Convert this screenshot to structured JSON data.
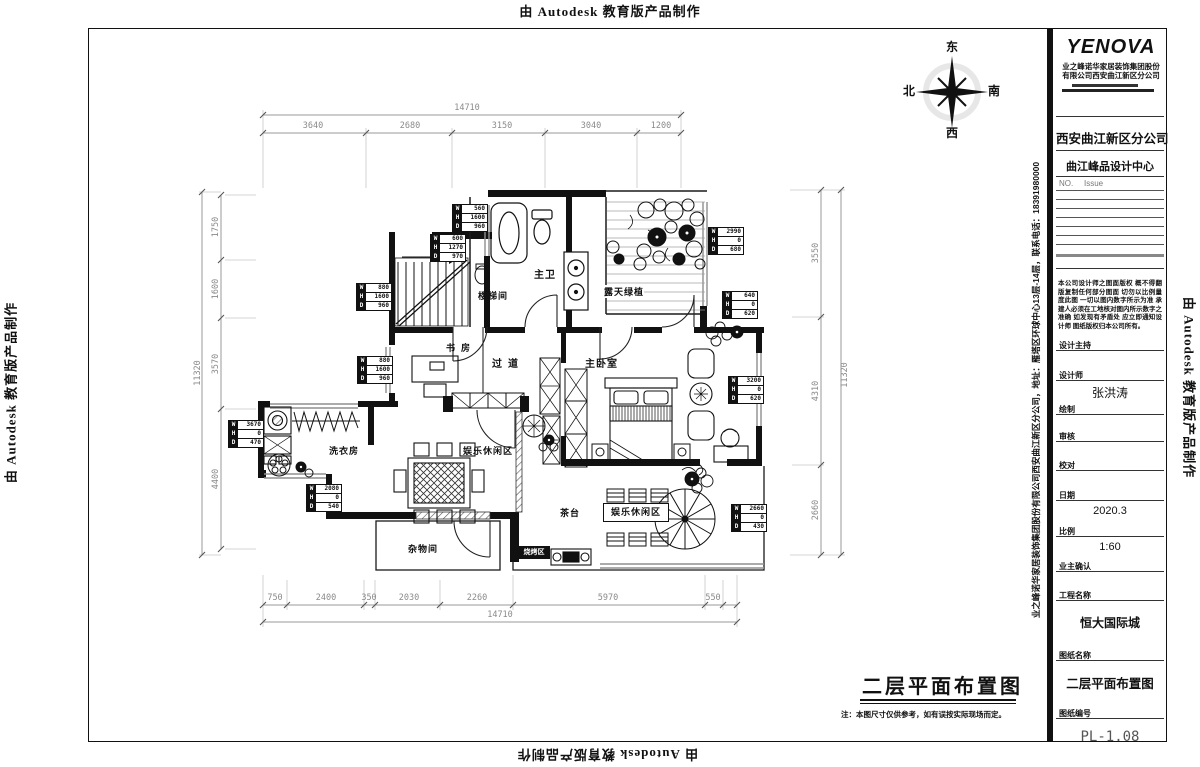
{
  "banner": {
    "text": "由 Autodesk 教育版产品制作"
  },
  "side_text": "业之峰诺华家居装饰集团股份有限公司西安曲江新区分公司，地址：雁塔区环球中心13层-14层，联系电话：18391980000",
  "compass": {
    "east": "东",
    "south": "南",
    "west": "西",
    "north": "北"
  },
  "plan": {
    "title": "二层平面布置图",
    "note": "注：本图尺寸仅供参考，如有误按实际现场而定。"
  },
  "rooms": [
    "主卫",
    "楼梯间",
    "露天绿植",
    "书房",
    "过道",
    "主卧室",
    "洗衣房",
    "娱乐休闲区",
    "杂物间",
    "茶台",
    "娱乐休闲区",
    "烧烤区"
  ],
  "dims": {
    "top_overall": "14710",
    "top_segments": [
      "3640",
      "2680",
      "3150",
      "3040",
      "1200"
    ],
    "bottom_overall": "14710",
    "bottom_segments": [
      "750",
      "2400",
      "350",
      "2030",
      "2260",
      "5970",
      "550"
    ],
    "left_overall": "11320",
    "left_segments": [
      "1750",
      "1600",
      "3570",
      "4400"
    ],
    "right_overall": "11320",
    "right_segments": [
      "3550",
      "4310",
      "2660"
    ]
  },
  "window_tag_keys": [
    "W",
    "H",
    "D"
  ],
  "window_tags": [
    {
      "w": "560",
      "h": "1600",
      "d": "960"
    },
    {
      "w": "600",
      "h": "1270",
      "d": "970"
    },
    {
      "w": "880",
      "h": "1600",
      "d": "960"
    },
    {
      "w": "880",
      "h": "1600",
      "d": "960"
    },
    {
      "w": "3670",
      "h": "0",
      "d": "470"
    },
    {
      "w": "2080",
      "h": "0",
      "d": "540"
    },
    {
      "w": "2990",
      "h": "0",
      "d": "680"
    },
    {
      "w": "640",
      "h": "0",
      "d": "620"
    },
    {
      "w": "3200",
      "h": "0",
      "d": "620"
    },
    {
      "w": "2660",
      "h": "0",
      "d": "430"
    }
  ],
  "title_block": {
    "logo": "YENOVA",
    "company_line1": "业之峰诺华家居装饰集团股份",
    "company_line2": "有限公司西安曲江新区分公司",
    "branch": "西安曲江新区分公司",
    "studio": "曲江峰品设计中心",
    "no_label": "NO.",
    "issue_label": "Issue",
    "disclaimer": "本公司设计师之图面版权 概不得翻版复制任何部分图面 切勿以比例量度此图 一切以图内数字所示为准 承建人必须在工地核对图内所示数字之准确 如发现有矛盾处 应立即通知设计师 图纸版权归本公司所有。",
    "design_lead_label": "设计主持",
    "designer_label": "设计师",
    "designer_value": "张洪涛",
    "draft_label": "绘制",
    "review_label": "审核",
    "proof_label": "校对",
    "date_label": "日期",
    "date_value": "2020.3",
    "scale_label": "比例",
    "scale_value": "1:60",
    "owner_label": "业主确认",
    "project_label": "工程名称",
    "project_value": "恒大国际城",
    "drawing_label": "图纸名称",
    "drawing_value": "二层平面布置图",
    "number_label": "图纸编号",
    "number_value": "PL-1.08"
  },
  "colors": {
    "wall": "#111111",
    "dim_text": "#8a8a8a",
    "paper": "#ffffff"
  }
}
